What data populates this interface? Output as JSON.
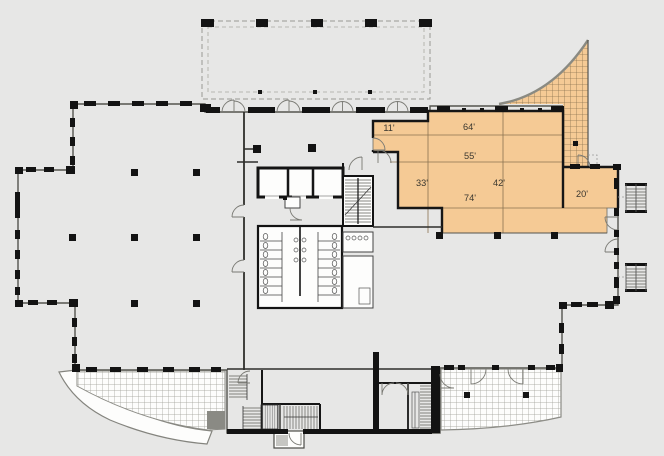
{
  "title": "AVAILABLE SPACE",
  "plan": {
    "colors": {
      "background": "#e7e7e6",
      "interior": "#fdfdfc",
      "wall": "#161616",
      "highlight": "#f5ca95",
      "highlight_line": "#8a7250"
    },
    "available_space": {
      "dimensions": [
        {
          "text": "11'"
        },
        {
          "text": "64'"
        },
        {
          "text": "55'"
        },
        {
          "text": "33'"
        },
        {
          "text": "42'"
        },
        {
          "text": "74'"
        },
        {
          "text": "20'"
        }
      ]
    }
  }
}
